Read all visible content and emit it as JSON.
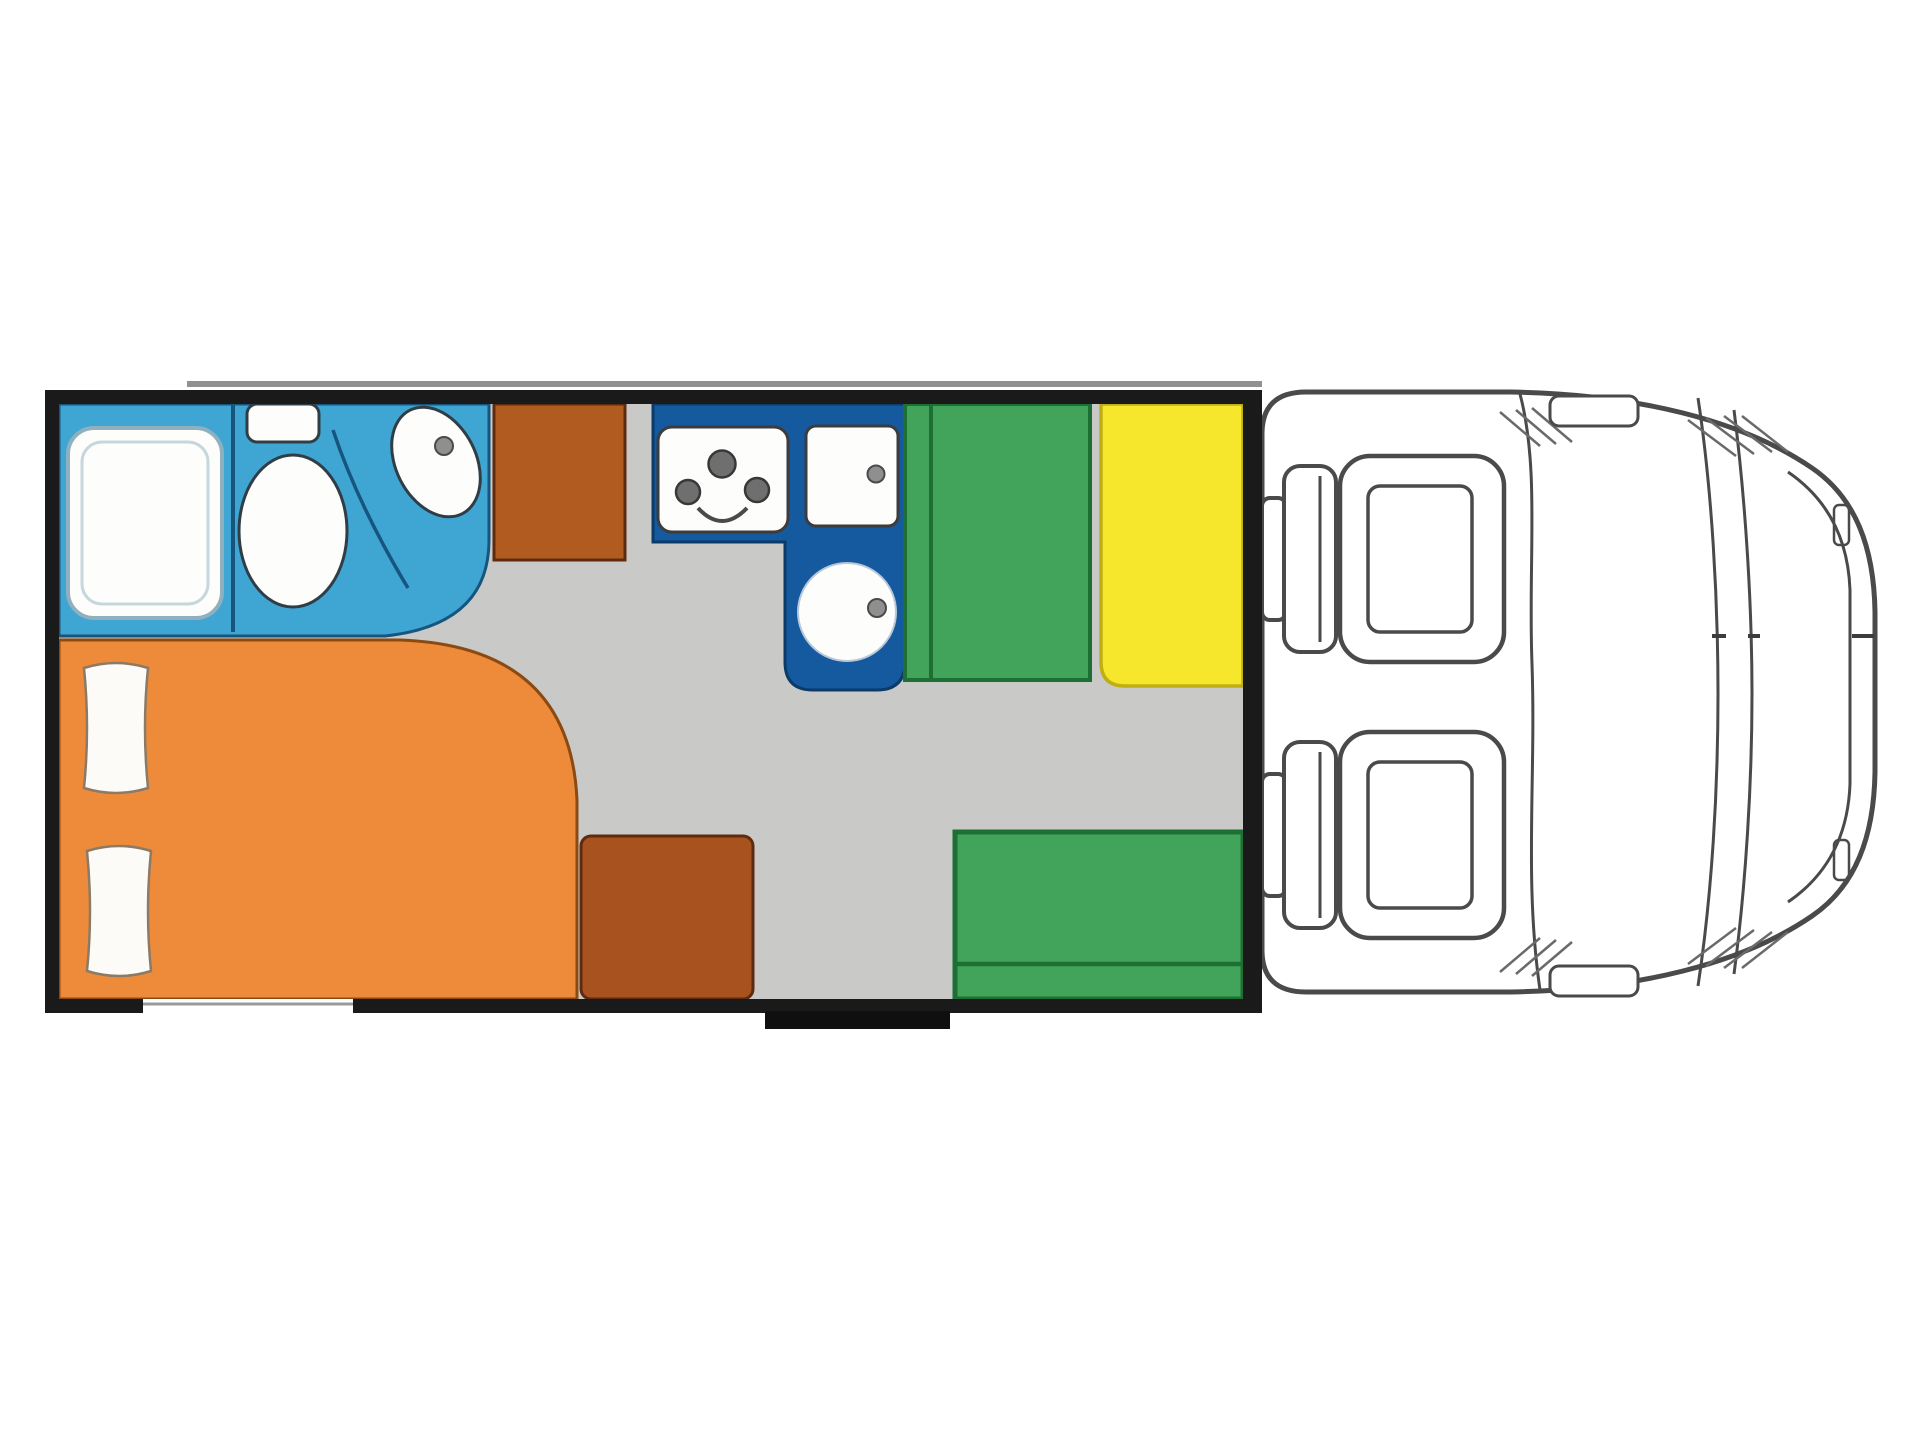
{
  "title": "Motorhome floor plan, top view: rear bathroom and double bed, mid kitchen, dinette with table and benches, driver cab with two seats",
  "colors": {
    "background": "#FFFFFF",
    "wall": "#1A1A1A",
    "floor": "#C9C9C7",
    "rail": "#919191",
    "bathroom": "#3FA5D3",
    "bathroom_line": "#16557E",
    "kitchen": "#15599F",
    "kitchen_line": "#0B3B69",
    "wardrobe": "#B25B20",
    "cabinet": "#A7521F",
    "wood_line": "#5E2B0E",
    "bed": "#EE8B3B",
    "bed_line": "#8A4A12",
    "bench": "#42A45A",
    "bench_line": "#1E6F34",
    "table": "#F6E62C",
    "table_line": "#BFAE14",
    "fixture": "#FDFDFB",
    "fixture_line": "#2F3E46",
    "appliance_line": "#3C3C3C",
    "burner": "#6F6F6F",
    "burner_line": "#383838",
    "metal": "#8F8F8F",
    "metal_line": "#4A4A4A",
    "pillow": "#FCFBF7",
    "pillow_line": "#8A7A66",
    "shower_ring": "#8FB0BE",
    "shower_ring_inner": "#C5D6DD",
    "sink_ring": "#B9C8D8",
    "cab_line": "#4A4A4A",
    "hatch_line": "#6A6A6A",
    "step": "#0F0F0F",
    "hatch_gap": "#9A9A9A"
  },
  "regions": {
    "bathroom": "bathroom with shower, toilet and washbasin",
    "shower": "shower tray",
    "toilet": "toilet",
    "washbasin": "washbasin",
    "wardrobe": "wardrobe cabinet",
    "kitchen": "L-shaped kitchen counter",
    "hob": "3-burner hob",
    "worktop": "worktop flap",
    "kitchen_sink": "round kitchen sink",
    "bed": "rear double bed",
    "pillows": "two pillows",
    "cabinet": "storage cabinet",
    "bench_front": "forward dinette bench",
    "bench_rear": "side dinette bench",
    "table": "dinette table",
    "garage_hatch": "rear garage hatch opening",
    "entry_step": "entry door step",
    "cab": "driver cab",
    "seats": "swivel cab seats",
    "windshield": "windshield",
    "mirrors": "cab trim details"
  }
}
